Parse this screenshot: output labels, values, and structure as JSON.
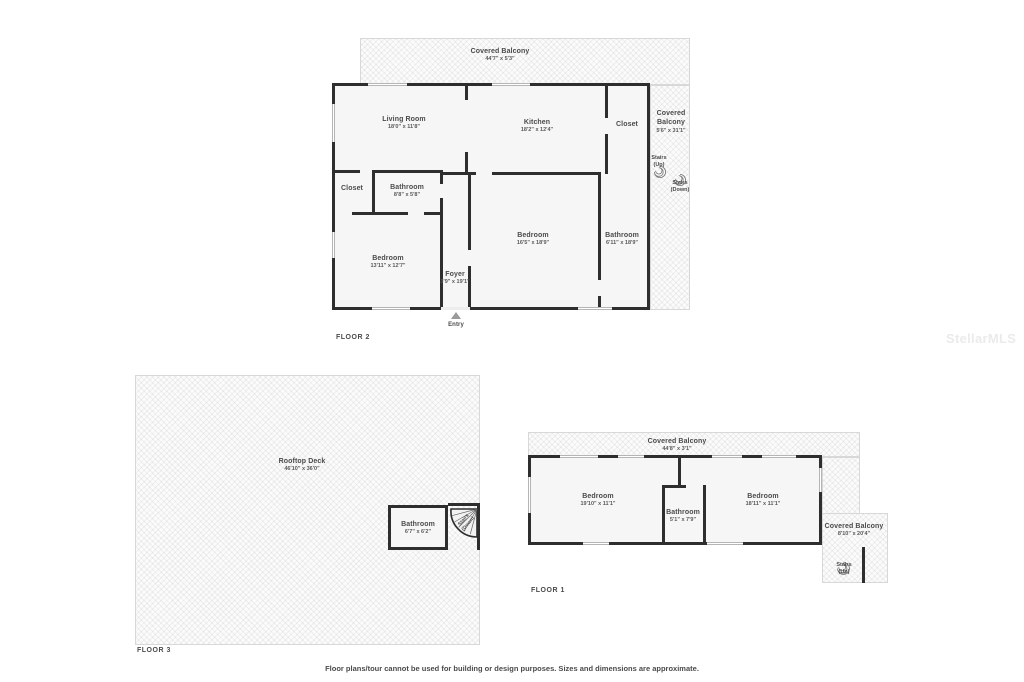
{
  "watermark": "StellarMLS",
  "disclaimer": "Floor plans/tour cannot be used for building or design purposes. Sizes and dimensions are approximate.",
  "floor2": {
    "label": "FLOOR 2",
    "entry_label": "Entry",
    "balcony_top": {
      "name": "Covered Balcony",
      "dims": "44'7\" x 5'3\""
    },
    "balcony_right": {
      "line1": "Covered",
      "line2": "Balcony",
      "dims": "5'6\" x 31'1\""
    },
    "living": {
      "name": "Living Room",
      "dims": "18'0\" x 11'8\""
    },
    "kitchen": {
      "name": "Kitchen",
      "dims": "18'2\" x 12'4\""
    },
    "closet_top": {
      "name": "Closet"
    },
    "closet_mid": {
      "name": "Closet"
    },
    "bathroom_small": {
      "name": "Bathroom",
      "dims": "8'8\" x 5'8\""
    },
    "bedroom_left": {
      "name": "Bedroom",
      "dims": "13'11\" x 12'7\""
    },
    "foyer": {
      "name": "Foyer",
      "dims": "3'9\" x 19'1\""
    },
    "bedroom_mid": {
      "name": "Bedroom",
      "dims": "16'5\" x 18'9\""
    },
    "bathroom_mid": {
      "name": "Bathroom",
      "dims": "6'11\" x 18'9\""
    },
    "stairs_up": {
      "line1": "Stairs",
      "line2": "(Up)"
    },
    "stairs_down": {
      "line1": "Stairs",
      "line2": "(Down)"
    }
  },
  "floor3": {
    "label": "FLOOR 3",
    "deck": {
      "name": "Rooftop Deck",
      "dims": "46'10\" x 36'0\""
    },
    "bathroom": {
      "name": "Bathroom",
      "dims": "6'7\" x 6'2\""
    },
    "stairs_down": {
      "line1": "Stairs",
      "line2": "(Down)"
    }
  },
  "floor1": {
    "label": "FLOOR 1",
    "balcony_top": {
      "name": "Covered Balcony",
      "dims": "44'8\" x 3'1\""
    },
    "balcony_right": {
      "name": "Covered Balcony",
      "dims": "8'10\" x 20'4\""
    },
    "bedroom_left": {
      "name": "Bedroom",
      "dims": "19'10\" x 11'1\""
    },
    "bathroom": {
      "name": "Bathroom",
      "dims": "5'1\" x 7'9\""
    },
    "bedroom_right": {
      "name": "Bedroom",
      "dims": "18'11\" x 11'1\""
    },
    "stairs_up": {
      "line1": "Stairs",
      "line2": "(Up)"
    }
  }
}
